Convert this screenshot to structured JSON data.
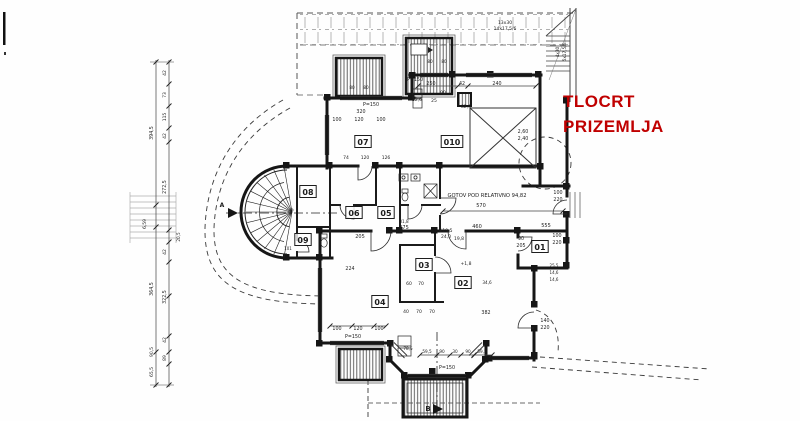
{
  "title": {
    "line1": "TLOCRT",
    "line2": "PRIZEMLJA",
    "color": "#c00000"
  },
  "plan": {
    "room_labels": [
      {
        "id": "07",
        "x": 363,
        "y": 142
      },
      {
        "id": "010",
        "x": 452,
        "y": 142
      },
      {
        "id": "06",
        "x": 354,
        "y": 213
      },
      {
        "id": "05",
        "x": 386,
        "y": 213
      },
      {
        "id": "08",
        "x": 308,
        "y": 192
      },
      {
        "id": "09",
        "x": 303,
        "y": 240
      },
      {
        "id": "03",
        "x": 424,
        "y": 265
      },
      {
        "id": "04",
        "x": 380,
        "y": 302
      },
      {
        "id": "02",
        "x": 463,
        "y": 283
      },
      {
        "id": "01",
        "x": 540,
        "y": 247
      }
    ],
    "annotations": [
      {
        "t": "GOTOV POD RELATIVNO 94,82",
        "x": 487,
        "y": 197,
        "s": 5.2
      },
      {
        "t": "570",
        "x": 481,
        "y": 207,
        "s": 5
      },
      {
        "t": "460",
        "x": 477,
        "y": 228,
        "s": 5
      },
      {
        "t": "555",
        "x": 546,
        "y": 227,
        "s": 5
      },
      {
        "t": "275",
        "x": 404,
        "y": 229,
        "s": 5
      },
      {
        "t": "205",
        "x": 360,
        "y": 238,
        "s": 5
      },
      {
        "t": "119,5",
        "x": 446,
        "y": 232,
        "s": 4.5
      },
      {
        "t": "24,0",
        "x": 446,
        "y": 238,
        "s": 4.5
      },
      {
        "t": "19,8",
        "x": 459,
        "y": 240,
        "s": 4.5
      },
      {
        "t": "31,8",
        "x": 404,
        "y": 223,
        "s": 4.2
      },
      {
        "t": "P=150",
        "x": 371,
        "y": 106,
        "s": 4.8
      },
      {
        "t": "P=150",
        "x": 415,
        "y": 81,
        "s": 4.8
      },
      {
        "t": "P=150",
        "x": 353,
        "y": 338,
        "s": 4.8
      },
      {
        "t": "P=150",
        "x": 447,
        "y": 369,
        "s": 4.8
      },
      {
        "t": "320",
        "x": 361,
        "y": 113,
        "s": 4.8
      },
      {
        "t": "100",
        "x": 337,
        "y": 121,
        "s": 4.8
      },
      {
        "t": "120",
        "x": 359,
        "y": 121,
        "s": 4.8
      },
      {
        "t": "100",
        "x": 381,
        "y": 121,
        "s": 4.8
      },
      {
        "t": "250",
        "x": 431,
        "y": 85,
        "s": 4.8
      },
      {
        "t": "42",
        "x": 462,
        "y": 85,
        "s": 4.8
      },
      {
        "t": "240",
        "x": 497,
        "y": 85,
        "s": 4.8
      },
      {
        "t": "90",
        "x": 443,
        "y": 94,
        "s": 4.5
      },
      {
        "t": "52,6",
        "x": 417,
        "y": 101,
        "s": 4.5
      },
      {
        "t": "25",
        "x": 434,
        "y": 102,
        "s": 4.5
      },
      {
        "t": "82,6",
        "x": 466,
        "y": 108,
        "s": 4.5
      },
      {
        "t": "2,60",
        "x": 523,
        "y": 133,
        "s": 4.8
      },
      {
        "t": "2,40",
        "x": 523,
        "y": 140,
        "s": 4.8
      },
      {
        "t": "74",
        "x": 346,
        "y": 159,
        "s": 4.5
      },
      {
        "t": "120",
        "x": 365,
        "y": 159,
        "s": 4.5
      },
      {
        "t": "126",
        "x": 386,
        "y": 159,
        "s": 4.5
      },
      {
        "t": "224",
        "x": 350,
        "y": 270,
        "s": 4.8
      },
      {
        "t": "60",
        "x": 409,
        "y": 285,
        "s": 4.5
      },
      {
        "t": "70",
        "x": 421,
        "y": 285,
        "s": 4.5
      },
      {
        "t": "40",
        "x": 406,
        "y": 313,
        "s": 4.5
      },
      {
        "t": "70",
        "x": 419,
        "y": 313,
        "s": 4.5
      },
      {
        "t": "70",
        "x": 432,
        "y": 313,
        "s": 4.5
      },
      {
        "t": "382",
        "x": 486,
        "y": 314,
        "s": 4.8
      },
      {
        "t": "100",
        "x": 337,
        "y": 330,
        "s": 4.8
      },
      {
        "t": "120",
        "x": 358,
        "y": 330,
        "s": 4.8
      },
      {
        "t": "100",
        "x": 379,
        "y": 330,
        "s": 4.8
      },
      {
        "t": "+1,8",
        "x": 466,
        "y": 265,
        "s": 4.5
      },
      {
        "t": "34,6",
        "x": 487,
        "y": 284,
        "s": 4.2
      },
      {
        "t": "90",
        "x": 521,
        "y": 240,
        "s": 4.8
      },
      {
        "t": "205",
        "x": 521,
        "y": 247,
        "s": 4.8
      },
      {
        "t": "100",
        "x": 557,
        "y": 237,
        "s": 4.8
      },
      {
        "t": "220",
        "x": 557,
        "y": 244,
        "s": 4.8
      },
      {
        "t": "100",
        "x": 558,
        "y": 194,
        "s": 4.8
      },
      {
        "t": "220",
        "x": 558,
        "y": 201,
        "s": 4.8
      },
      {
        "t": "140",
        "x": 545,
        "y": 322,
        "s": 4.8
      },
      {
        "t": "220",
        "x": 545,
        "y": 329,
        "s": 4.8
      },
      {
        "t": "25,5",
        "x": 554,
        "y": 267,
        "s": 4
      },
      {
        "t": "14,6",
        "x": 554,
        "y": 274,
        "s": 4
      },
      {
        "t": "14,6",
        "x": 554,
        "y": 281,
        "s": 4
      },
      {
        "t": "13x30",
        "x": 505,
        "y": 24,
        "s": 4.5
      },
      {
        "t": "14x17,5/6",
        "x": 505,
        "y": 30,
        "s": 4.5
      },
      {
        "t": "4x30",
        "x": 559,
        "y": 52,
        "s": 4.2,
        "r": -90
      },
      {
        "t": "5x17,5/6",
        "x": 566,
        "y": 52,
        "s": 4.2,
        "r": -90
      },
      {
        "t": "80",
        "x": 352,
        "y": 89,
        "s": 4.2
      },
      {
        "t": "80",
        "x": 366,
        "y": 89,
        "s": 4.2
      },
      {
        "t": "80",
        "x": 430,
        "y": 63,
        "s": 4.2
      },
      {
        "t": "80",
        "x": 444,
        "y": 63,
        "s": 4.2
      },
      {
        "t": "101",
        "x": 288,
        "y": 250,
        "s": 4
      },
      {
        "t": "59,5",
        "x": 427,
        "y": 353,
        "s": 4.2
      },
      {
        "t": "90",
        "x": 442,
        "y": 353,
        "s": 4.2
      },
      {
        "t": "30",
        "x": 455,
        "y": 353,
        "s": 4.2
      },
      {
        "t": "90",
        "x": 468,
        "y": 353,
        "s": 4.2
      },
      {
        "t": "59,5",
        "x": 482,
        "y": 353,
        "s": 4.2
      },
      {
        "t": "78,5",
        "x": 408,
        "y": 350,
        "s": 4.2
      },
      {
        "t": "394,5",
        "x": 153,
        "y": 133,
        "s": 4.8,
        "r": -90
      },
      {
        "t": "364,5",
        "x": 153,
        "y": 289,
        "s": 4.8,
        "r": -90
      },
      {
        "t": "90,5",
        "x": 153,
        "y": 352,
        "s": 4.5,
        "r": -90
      },
      {
        "t": "65,5",
        "x": 153,
        "y": 372,
        "s": 4.5,
        "r": -90
      },
      {
        "t": "42",
        "x": 166,
        "y": 73,
        "s": 4.5,
        "r": -90
      },
      {
        "t": "73",
        "x": 166,
        "y": 95,
        "s": 4.5,
        "r": -90
      },
      {
        "t": "115",
        "x": 166,
        "y": 117,
        "s": 4.5,
        "r": -90
      },
      {
        "t": "42",
        "x": 166,
        "y": 136,
        "s": 4.5,
        "r": -90
      },
      {
        "t": "272,5",
        "x": 166,
        "y": 187,
        "s": 4.8,
        "r": -90
      },
      {
        "t": "20,5",
        "x": 180,
        "y": 237,
        "s": 4.2,
        "r": -90
      },
      {
        "t": "42",
        "x": 166,
        "y": 252,
        "s": 4.5,
        "r": -90
      },
      {
        "t": "322,5",
        "x": 166,
        "y": 297,
        "s": 4.8,
        "r": -90
      },
      {
        "t": "42",
        "x": 166,
        "y": 340,
        "s": 4.5,
        "r": -90
      },
      {
        "t": "89",
        "x": 166,
        "y": 358,
        "s": 4.5,
        "r": -90
      },
      {
        "t": "6,59",
        "x": 146,
        "y": 224,
        "s": 4.5,
        "r": -90
      },
      {
        "t": "B",
        "x": 428,
        "y": 411,
        "s": 7,
        "b": 1
      },
      {
        "t": "A",
        "x": 222,
        "y": 207,
        "s": 6,
        "b": 1
      }
    ]
  }
}
